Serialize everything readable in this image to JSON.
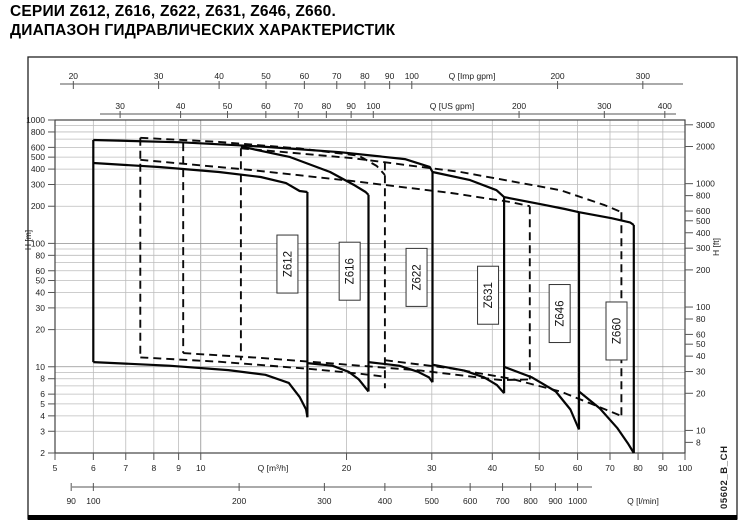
{
  "page": {
    "title_line1": "СЕРИИ Z612, Z616, Z622, Z631, Z646, Z660.",
    "title_line2": "ДИАПАЗОН ГИДРАВЛИЧЕСКИХ ХАРАКТЕРИСТИК",
    "doc_code": "05602_B_CH"
  },
  "chart_data": {
    "type": "line",
    "scale": "log-log",
    "x_range_m3h": [
      5,
      100
    ],
    "y_range_m": [
      2,
      1000
    ],
    "grid_on": true,
    "x_axes": [
      {
        "id": "imp",
        "label": "Q [Imp gpm]",
        "unit_to_m3h": 0.272765,
        "ticks": [
          20,
          30,
          40,
          50,
          60,
          70,
          80,
          90,
          100,
          200,
          300
        ]
      },
      {
        "id": "us",
        "label": "Q [US gpm]",
        "unit_to_m3h": 0.227125,
        "ticks": [
          30,
          40,
          50,
          60,
          70,
          80,
          90,
          100,
          200,
          300,
          400
        ]
      },
      {
        "id": "m3h",
        "label": "Q [m³/h]",
        "unit_to_m3h": 1,
        "ticks": [
          5,
          6,
          7,
          8,
          9,
          10,
          20,
          30,
          40,
          50,
          60,
          70,
          80,
          90,
          100
        ]
      },
      {
        "id": "lmin",
        "label": "Q [l/min]",
        "unit_to_m3h": 0.06,
        "ticks": [
          90,
          100,
          200,
          300,
          400,
          500,
          600,
          700,
          800,
          900,
          1000
        ]
      }
    ],
    "y_axes": [
      {
        "id": "m",
        "label": "H [m]",
        "unit_to_m": 1,
        "ticks": [
          1000,
          800,
          600,
          500,
          400,
          300,
          200,
          100,
          80,
          60,
          50,
          40,
          30,
          20,
          10,
          8,
          6,
          5,
          4,
          3,
          2
        ]
      },
      {
        "id": "ft",
        "label": "H [ft]",
        "unit_to_m": 0.3048,
        "ticks": [
          3000,
          2000,
          1000,
          800,
          600,
          500,
          400,
          300,
          200,
          100,
          80,
          60,
          50,
          40,
          30,
          20,
          10,
          8
        ]
      }
    ],
    "grid": {
      "x": [
        5,
        6,
        7,
        8,
        9,
        10,
        20,
        30,
        40,
        50,
        60,
        70,
        80,
        90,
        100
      ],
      "y": [
        2,
        3,
        4,
        5,
        6,
        7,
        8,
        9,
        10,
        20,
        30,
        40,
        50,
        60,
        70,
        80,
        90,
        100,
        200,
        300,
        400,
        500,
        600,
        700,
        800,
        900,
        1000
      ]
    },
    "series": [
      {
        "name": "Z612",
        "label_pos": [
          15.1,
          68
        ],
        "curves": {
          "left": [
            [
              6,
              689
            ],
            [
              6,
              10.9
            ]
          ],
          "top": [
            [
              6,
              448
            ],
            [
              8.2,
              416
            ],
            [
              10.9,
              379
            ],
            [
              13.3,
              345
            ],
            [
              15,
              308
            ],
            [
              16,
              266
            ],
            [
              16.6,
              261
            ]
          ],
          "right": [
            [
              16.6,
              261
            ],
            [
              16.6,
              3.9
            ]
          ],
          "bottom": [
            [
              6,
              10.9
            ],
            [
              8.6,
              10.2
            ],
            [
              11.4,
              9.4
            ],
            [
              13.6,
              8.6
            ],
            [
              15.2,
              7.4
            ],
            [
              16,
              5.7
            ],
            [
              16.5,
              4.5
            ],
            [
              16.6,
              3.9
            ]
          ]
        }
      },
      {
        "name": "Z616",
        "label_pos": [
          20.3,
          59.5
        ],
        "curves": {
          "top": [
            [
              12.1,
              610
            ],
            [
              15.3,
              500
            ],
            [
              18.5,
              379
            ],
            [
              20.8,
              295
            ],
            [
              21.9,
              261
            ],
            [
              22.2,
              247
            ]
          ],
          "right": [
            [
              22.2,
              247
            ],
            [
              22.2,
              6.3
            ]
          ],
          "bottom": [
            [
              16.6,
              10.7
            ],
            [
              18.7,
              10.2
            ],
            [
              20.2,
              9.1
            ],
            [
              21.2,
              7.9
            ],
            [
              22.2,
              6.3
            ]
          ]
        }
      },
      {
        "name": "Z622",
        "label_pos": [
          27.9,
          53
        ],
        "curves": {
          "top": [
            [
              6,
              689
            ],
            [
              9.1,
              659
            ],
            [
              13.3,
              610
            ],
            [
              19.4,
              548
            ],
            [
              26.4,
              482
            ],
            [
              29.7,
              417
            ],
            [
              30.1,
              379
            ]
          ],
          "right": [
            [
              30.1,
              379
            ],
            [
              30.1,
              7.5
            ]
          ],
          "bottom": [
            [
              22.2,
              10.9
            ],
            [
              25.7,
              10.2
            ],
            [
              28.1,
              9.1
            ],
            [
              29.6,
              8.2
            ],
            [
              30.1,
              7.5
            ]
          ]
        }
      },
      {
        "name": "Z631",
        "label_pos": [
          39.2,
          38
        ],
        "curves": {
          "top": [
            [
              30.1,
              379
            ],
            [
              36,
              326
            ],
            [
              40.8,
              270
            ],
            [
              42.3,
              237
            ]
          ],
          "right": [
            [
              42.3,
              237
            ],
            [
              42.3,
              6.1
            ]
          ],
          "bottom": [
            [
              30.1,
              10.4
            ],
            [
              35,
              9.3
            ],
            [
              38.5,
              8.2
            ],
            [
              40.9,
              7.1
            ],
            [
              42.3,
              6.1
            ]
          ]
        }
      },
      {
        "name": "Z646",
        "label_pos": [
          55.1,
          27
        ],
        "curves": {
          "top": [
            [
              42.3,
              237
            ],
            [
              50.2,
              208
            ],
            [
              56.5,
              190
            ],
            [
              60.4,
              179
            ]
          ],
          "right": [
            [
              60.4,
              179
            ],
            [
              60.4,
              3.1
            ]
          ],
          "bottom": [
            [
              42.3,
              10
            ],
            [
              48.3,
              8.2
            ],
            [
              54.1,
              6.3
            ],
            [
              58,
              4.5
            ],
            [
              60.4,
              3.1
            ]
          ]
        }
      },
      {
        "name": "Z660",
        "label_pos": [
          72.2,
          19.5
        ],
        "curves": {
          "top": [
            [
              60.4,
              179
            ],
            [
              70.5,
              160
            ],
            [
              77,
              148
            ],
            [
              78.4,
              141
            ]
          ],
          "right": [
            [
              78.4,
              141
            ],
            [
              78.4,
              2
            ]
          ],
          "bottom": [
            [
              60.4,
              6.3
            ],
            [
              66.7,
              4.6
            ],
            [
              72.4,
              3.2
            ],
            [
              76.2,
              2.4
            ],
            [
              78.4,
              2
            ]
          ]
        }
      }
    ],
    "overlay_60hz": {
      "style": "dashed",
      "curves": [
        [
          [
            7.5,
            718
          ],
          [
            7.5,
            11.9
          ]
        ],
        [
          [
            9.2,
            650
          ],
          [
            9.2,
            12.9
          ]
        ],
        [
          [
            12.1,
            590
          ],
          [
            12.1,
            11.3
          ]
        ],
        [
          [
            24,
            455
          ],
          [
            24,
            6.7
          ]
        ],
        [
          [
            47.8,
            200
          ],
          [
            47.8,
            7.9
          ]
        ],
        [
          [
            73.9,
            179
          ],
          [
            73.9,
            4.0
          ]
        ],
        [
          [
            7.5,
            718
          ],
          [
            10.9,
            664
          ],
          [
            16,
            588
          ],
          [
            21.2,
            514
          ],
          [
            23.1,
            424
          ],
          [
            24,
            358
          ]
        ],
        [
          [
            7.5,
            476
          ],
          [
            12.7,
            393
          ],
          [
            20.6,
            320
          ],
          [
            32.9,
            256
          ],
          [
            43.7,
            216
          ],
          [
            47.8,
            200
          ]
        ],
        [
          [
            12.1,
            590
          ],
          [
            20.6,
            490
          ],
          [
            34.4,
            379
          ],
          [
            55.3,
            270
          ],
          [
            68.3,
            204
          ],
          [
            73.9,
            179
          ]
        ],
        [
          [
            7.5,
            11.9
          ],
          [
            10.9,
            11.0
          ],
          [
            16.8,
            9.6
          ],
          [
            21.2,
            8.8
          ],
          [
            24,
            8.3
          ]
        ],
        [
          [
            9.2,
            12.9
          ],
          [
            13.3,
            11.8
          ],
          [
            19.4,
            10.5
          ],
          [
            28.5,
            9.3
          ],
          [
            41.7,
            7.8
          ],
          [
            47.8,
            7.9
          ]
        ],
        [
          [
            24,
            11.3
          ],
          [
            32.9,
            9.7
          ],
          [
            43.7,
            8.0
          ],
          [
            55.3,
            6.3
          ],
          [
            66.7,
            4.7
          ],
          [
            73.9,
            4.0
          ]
        ]
      ]
    }
  }
}
